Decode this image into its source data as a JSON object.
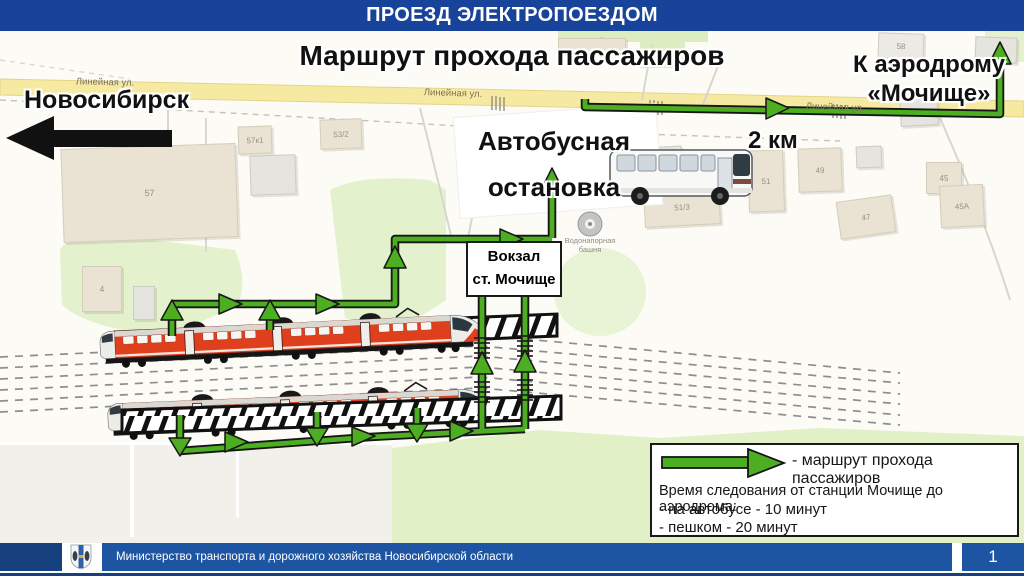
{
  "slide": {
    "header_title": "ПРОЕЗД ЭЛЕКТРОПОЕЗДОМ",
    "footer_text": "Министерство транспорта и дорожного хозяйства Новосибирской области",
    "page_number": "1"
  },
  "map": {
    "title": "Маршрут прохода пассажиров",
    "city_direction": "Новосибирск",
    "aerodrome_direction": [
      "К аэродрому",
      "«Мочище»"
    ],
    "bus_stop": [
      "Автобусная",
      "остановка"
    ],
    "distance": "2 км",
    "station": [
      "Вокзал",
      "ст. Мочище"
    ],
    "water_tower": [
      "Водонапорная",
      "башня"
    ],
    "street_name": "Линейная ул.",
    "buildings": [
      "57",
      "57к1",
      "53/2",
      "4",
      "58",
      "51/4",
      "51/3",
      "51",
      "49",
      "47",
      "45",
      "45А"
    ]
  },
  "legend": {
    "route_label": "- маршрут прохода пассажиров",
    "travel_time_title": "Время следования от станции Мочище до аэродрома:",
    "travel_time_bus": "- на автобусе - 10 минут",
    "travel_time_walk": "- пешком - 20 минут"
  },
  "colors": {
    "header_blue": "#17439a",
    "footer_navy": "#16407e",
    "footer_panel_blue": "#1e55a2",
    "route_green": "#4cae20",
    "street_yellow": "#f6e9a2",
    "train_red": "#e03f1e"
  }
}
